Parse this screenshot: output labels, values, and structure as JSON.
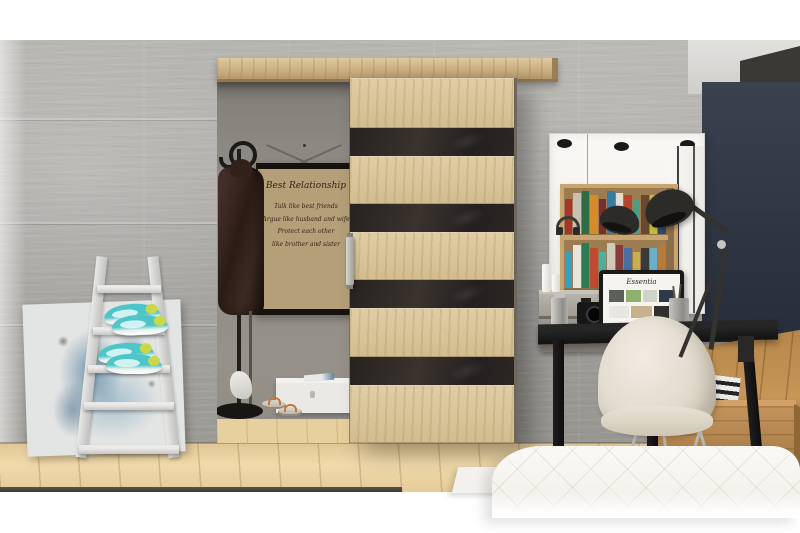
{
  "poster": {
    "title": "Best Relationship",
    "lines": [
      "Talk like best friends",
      "Argue like husband and wife",
      "Protect each other",
      "like brother and sister"
    ]
  },
  "monitor": {
    "screen_title": "Essentia"
  },
  "palette": {
    "concrete_wall": "#a9a7a3",
    "interior_wall": "#8d8983",
    "door_wood": "#d9c59b",
    "door_glass": "#2b2725",
    "rail_wood": "#c6a97c",
    "floor_wood": "#ecd4a6",
    "adjacent_floor": "#c9985a",
    "navy_wall": "#323a46",
    "desk_black": "#1a1a1a",
    "crate_wood": "#b5854e",
    "sneaker_teal": "#4cc6c8",
    "bed_white": "#f8f6f2"
  },
  "mirror": {
    "book_rows": [
      [
        "#a8352b",
        "#c8c0b0",
        "#2e6b46",
        "#d98a2b",
        "#7a2e2e",
        "#3a7ca0",
        "#e0ddd3",
        "#b4442e",
        "#4a9e86",
        "#6a4a2e",
        "#c4bc3c",
        "#2e4a6e"
      ],
      [
        "#3a9ec0",
        "#e8e4da",
        "#2e7a52",
        "#c04a32",
        "#4ab0a0",
        "#d0cabb",
        "#8a3a3a",
        "#4a6ea0",
        "#c8b04a",
        "#3a3a3a",
        "#6ab0c8",
        "#b87a3a"
      ]
    ]
  },
  "monitor_thumbs": {
    "row1": [
      "#5a5f58",
      "#8faf6e",
      "#cfd3c9",
      "#2e3a4a"
    ],
    "row2": [
      "#e8e6e0",
      "#c9b18e",
      "#32302e"
    ]
  }
}
